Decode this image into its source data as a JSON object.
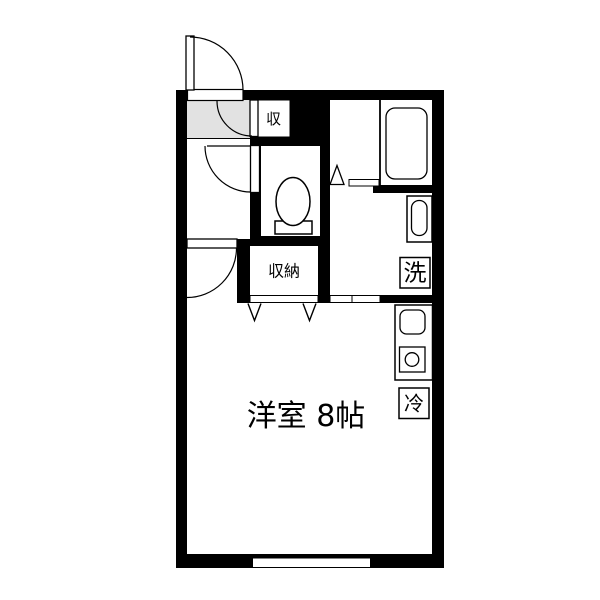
{
  "plan": {
    "type": "floorplan",
    "labels": {
      "main_room": "洋室 8帖",
      "closet": "収納",
      "entry_storage": "収",
      "washer": "洗",
      "fridge": "冷"
    },
    "colors": {
      "wall": "#000000",
      "background": "#ffffff",
      "genkan_floor": "#e2e2e2",
      "line": "#000000"
    }
  }
}
